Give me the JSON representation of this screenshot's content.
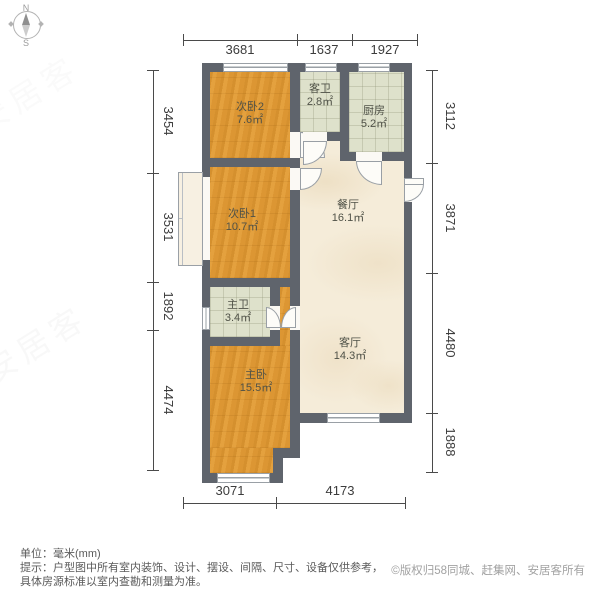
{
  "compass": {
    "north": "N",
    "south": "S"
  },
  "dimensions": {
    "unit": "mm",
    "top": [
      "3681",
      "1637",
      "1927"
    ],
    "left": [
      "3454",
      "3531",
      "1892",
      "4474"
    ],
    "right": [
      "3112",
      "3871",
      "4480",
      "1888"
    ],
    "bottom": [
      "3071",
      "4173"
    ]
  },
  "rooms": [
    {
      "name": "次卧2",
      "area": "7.6㎡"
    },
    {
      "name": "客卫",
      "area": "2.8㎡"
    },
    {
      "name": "厨房",
      "area": "5.2㎡"
    },
    {
      "name": "次卧1",
      "area": "10.7㎡"
    },
    {
      "name": "餐厅",
      "area": "16.1㎡"
    },
    {
      "name": "主卫",
      "area": "3.4㎡"
    },
    {
      "name": "客厅",
      "area": "14.3㎡"
    },
    {
      "name": "主卧",
      "area": "15.5㎡"
    }
  ],
  "footer": {
    "unit_label": "单位：毫米(mm)",
    "tip_line1": "提示：户型图中所有室内装饰、设计、摆设、间隔、尺寸、设备仅供参考，",
    "tip_line2": "具体房源标准以室内查勘和测量为准。",
    "copyright": "©版权归58同城、赶集网、安居客所有"
  },
  "watermark": "安居客",
  "colors": {
    "wall": "#5f646c",
    "wood_floor": "#df9a36",
    "tile_floor": "#dee1cb",
    "marble_floor": "#f5ecd9",
    "dim_text": "#3c3c3c"
  }
}
